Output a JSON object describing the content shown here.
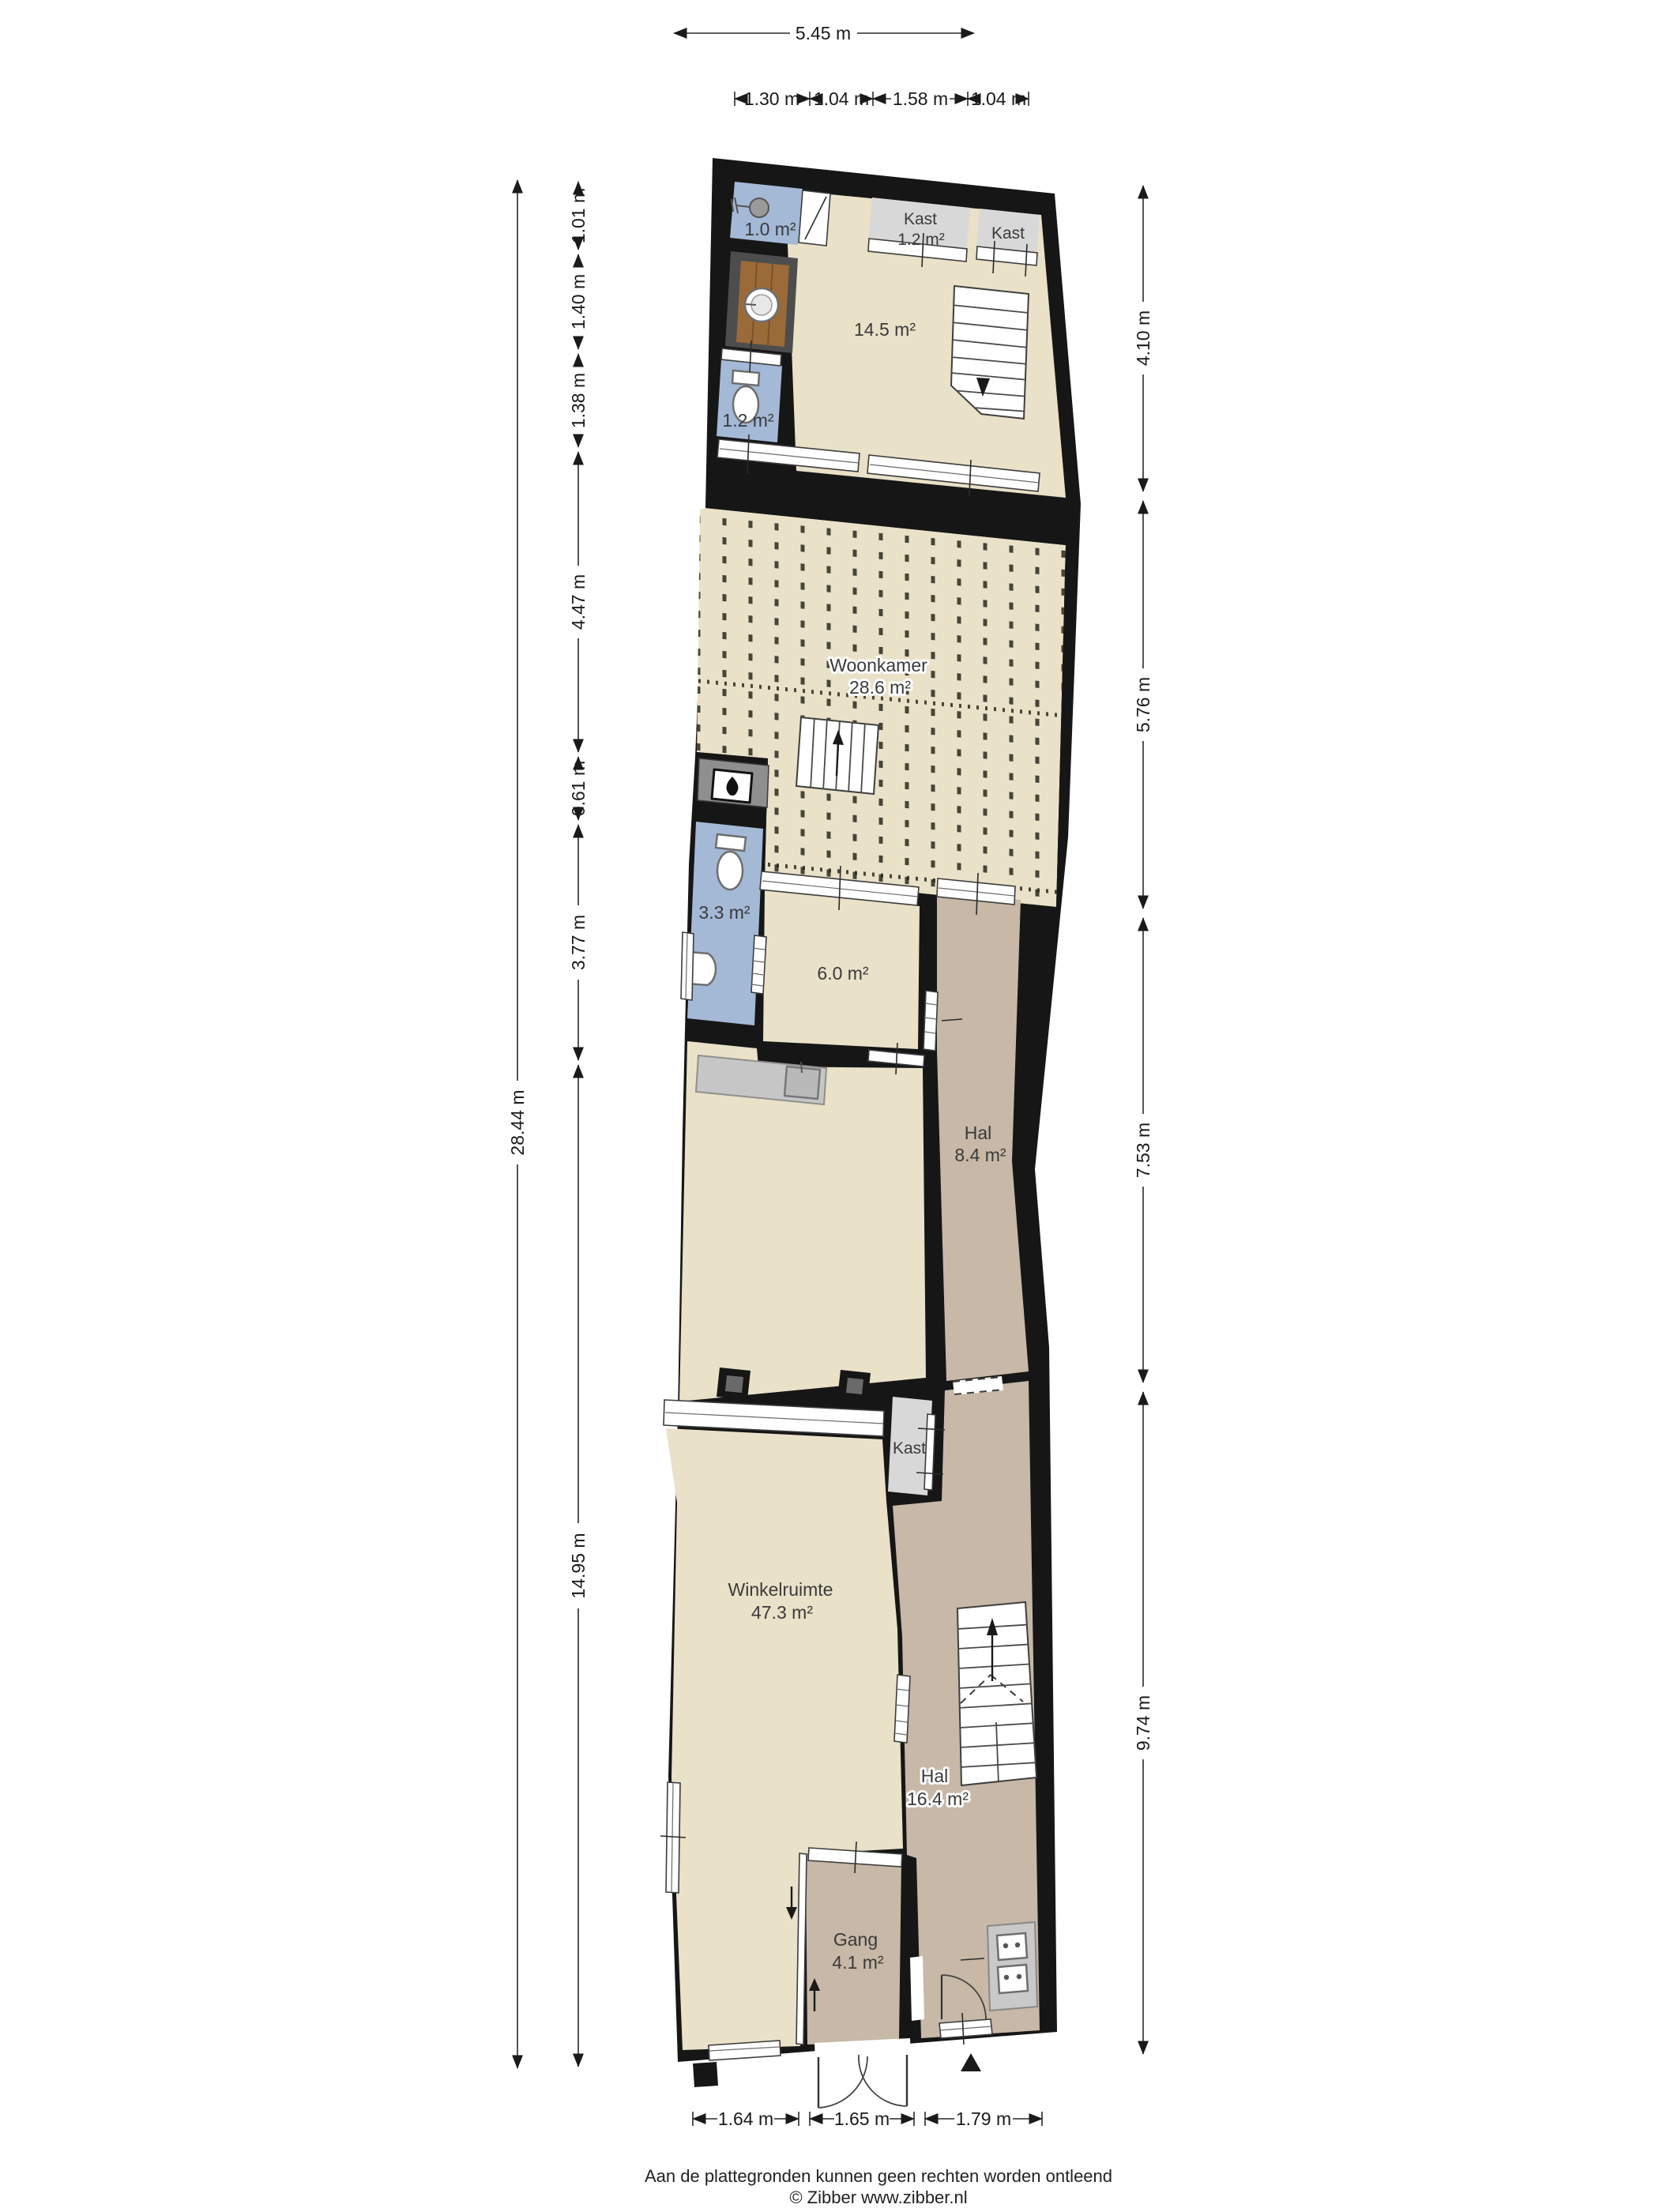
{
  "dimensions": {
    "top": {
      "overall": "5.45 m",
      "segments": [
        "1.30 m",
        "1.04 m",
        "1.58 m",
        "1.04 m"
      ]
    },
    "left": {
      "overall": "28.44 m",
      "segments": [
        "1.01 m",
        "1.40 m",
        "1.38 m",
        "4.47 m",
        "0.61 m",
        "3.77 m",
        "14.95 m"
      ]
    },
    "right": {
      "segments": [
        "4.10 m",
        "5.76 m",
        "7.53 m",
        "9.74 m"
      ]
    },
    "bottom": {
      "segments": [
        "1.64 m",
        "1.65 m",
        "1.79 m"
      ]
    }
  },
  "rooms": {
    "douche": {
      "area": "1.0 m²"
    },
    "kast_boven_1": {
      "name": "Kast",
      "area": "1.2 m²"
    },
    "kast_boven_2": {
      "name": "Kast"
    },
    "overloop": {
      "area": "14.5 m²"
    },
    "toilet_boven": {
      "area": "1.2 m²"
    },
    "woonkamer": {
      "name": "Woonkamer",
      "area": "28.6 m²"
    },
    "badkamer": {
      "area": "3.3 m²"
    },
    "keuken": {
      "area": "6.0 m²"
    },
    "hal_midden": {
      "name": "Hal",
      "area": "8.4 m²"
    },
    "winkelruimte": {
      "name": "Winkelruimte",
      "area": "47.3 m²"
    },
    "kast_beneden": {
      "name": "Kast"
    },
    "hal_beneden": {
      "name": "Hal",
      "area": "16.4 m²"
    },
    "gang": {
      "name": "Gang",
      "area": "4.1 m²"
    }
  },
  "footer": {
    "disclaimer": "Aan de plattegronden kunnen geen rechten worden ontleend",
    "credit": "© Zibber www.zibber.nl"
  },
  "colors": {
    "wall": "#161616",
    "floor_beige": "#e9e1c8",
    "floor_tan": "#c7b8a7",
    "floor_blue": "#a4b9d6",
    "closet_gray": "#d8d8d8",
    "wood": "#9b6a39",
    "wood_dark": "#7c5129",
    "counter": "#c6c6c6",
    "hearth": "#8f8f8f",
    "enclosure": "#4d4d4d",
    "texture_mark": "#2a2a1e"
  }
}
